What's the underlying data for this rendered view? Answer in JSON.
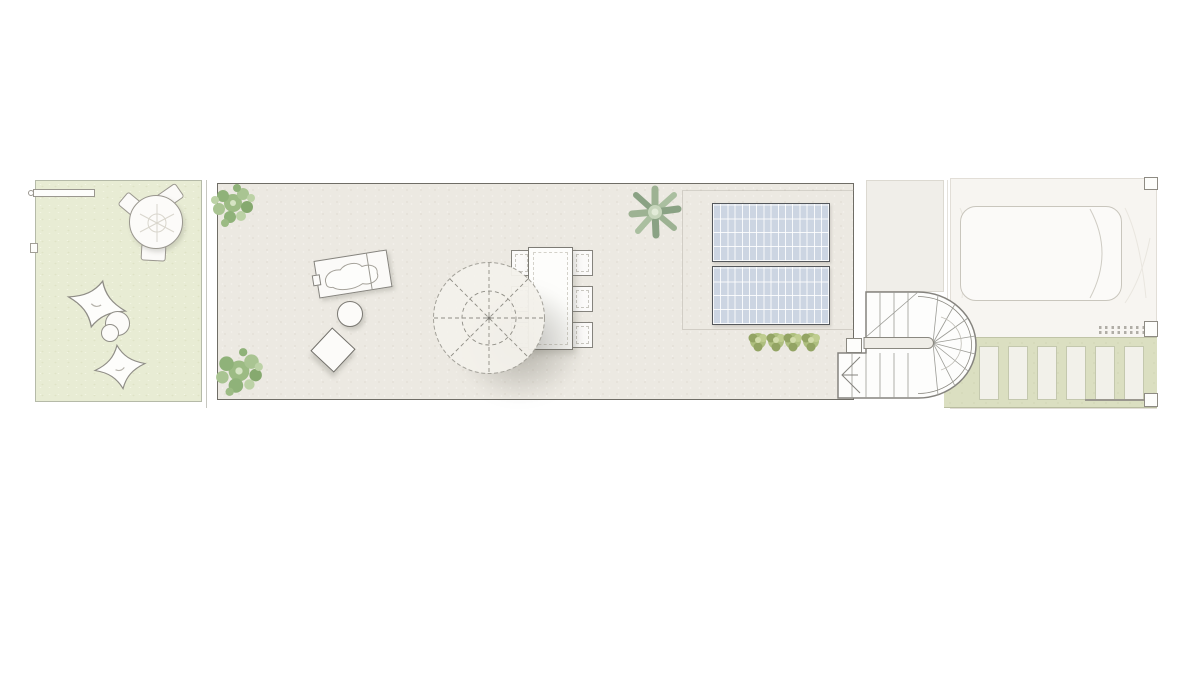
{
  "drawing": {
    "type": "architectural-roof-terrace-plan",
    "visible_text": [],
    "sections": [
      {
        "name": "lawn-garden",
        "items": [
          "round-table-set",
          "beanbag-chairs",
          "pouf",
          "section-marker-bar"
        ]
      },
      {
        "name": "roof-terrace",
        "items": [
          "corner-plants",
          "sun-lounger",
          "side-table",
          "ottoman",
          "parasol",
          "dining-table-with-chairs",
          "solar-panels",
          "shrub-row"
        ]
      },
      {
        "name": "stairwell",
        "items": [
          "u-shaped-winder-stair",
          "direction-arrow",
          "landing"
        ]
      },
      {
        "name": "driveway",
        "items": [
          "car-outline",
          "grate-hatch",
          "paver-walkway",
          "wall-tabs"
        ]
      }
    ]
  },
  "counts": {
    "solar_panels": 2,
    "dining_chairs_per_side": 3,
    "pavers": 6,
    "shrubs": 4,
    "garden_chairs": 3,
    "beanbags": 2,
    "parasol_spokes": 8
  },
  "colors": {
    "page": "#ffffff",
    "garden": "#e8ecd4",
    "gardenBorder": "#b5baa8",
    "terrace": "#ece9e2",
    "terraceBorder": "#6f6d66",
    "landing": "#f0eee9",
    "rightArea": "#f7f5f1",
    "paverStrip": "#dbdfc1",
    "paver": "#f2f1ea",
    "paverBorder": "#c4c8ae",
    "panel": "#ccd5e2",
    "panelBorder": "#54575b",
    "carFill": "#fbfaf8",
    "carBorder": "#c9c6bd",
    "stairLine": "#8f8d87",
    "plantGreen": "#8fb279",
    "plantLight": "#b9cfa4",
    "agaveGreen": "#9db293",
    "shrubGreen": "#a9b981"
  }
}
